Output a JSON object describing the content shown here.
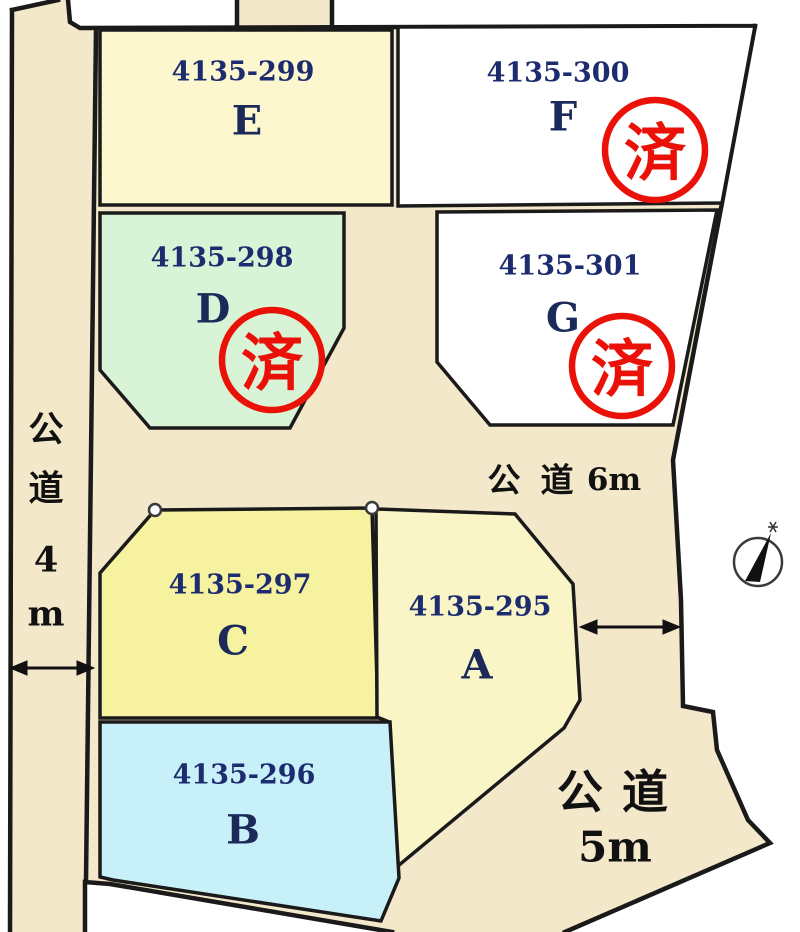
{
  "plots": [
    {
      "letter": "A",
      "parcel": "4135-295",
      "fill": "#faf5c6",
      "sold": false
    },
    {
      "letter": "B",
      "parcel": "4135-296",
      "fill": "#c8f0f8",
      "sold": false
    },
    {
      "letter": "C",
      "parcel": "4135-297",
      "fill": "#f7f2a0",
      "sold": false
    },
    {
      "letter": "D",
      "parcel": "4135-298",
      "fill": "#d8f3d6",
      "sold": true
    },
    {
      "letter": "E",
      "parcel": "4135-299",
      "fill": "#fcf7ce",
      "sold": false
    },
    {
      "letter": "F",
      "parcel": "4135-300",
      "fill": "#ffffff",
      "sold": true
    },
    {
      "letter": "G",
      "parcel": "4135-301",
      "fill": "#ffffff",
      "sold": true
    }
  ],
  "stamp": {
    "text": "済",
    "color": "#ea1208"
  },
  "roads": {
    "west": {
      "name": "公道 4m",
      "chars": [
        "公",
        "道",
        "4",
        "m"
      ]
    },
    "center": {
      "name": "公道 6m",
      "chars": [
        "公",
        "道"
      ],
      "width": "6m"
    },
    "south": {
      "name": "公道 5m",
      "chars": [
        "公",
        "道"
      ],
      "width": "5m"
    }
  },
  "colors": {
    "road_fill": "#f4e8ca",
    "boundary": "#1a1a1a",
    "parcel_number": "#1c2c6e",
    "plot_letter": "#1c2a5a",
    "road_label": "#111111"
  }
}
